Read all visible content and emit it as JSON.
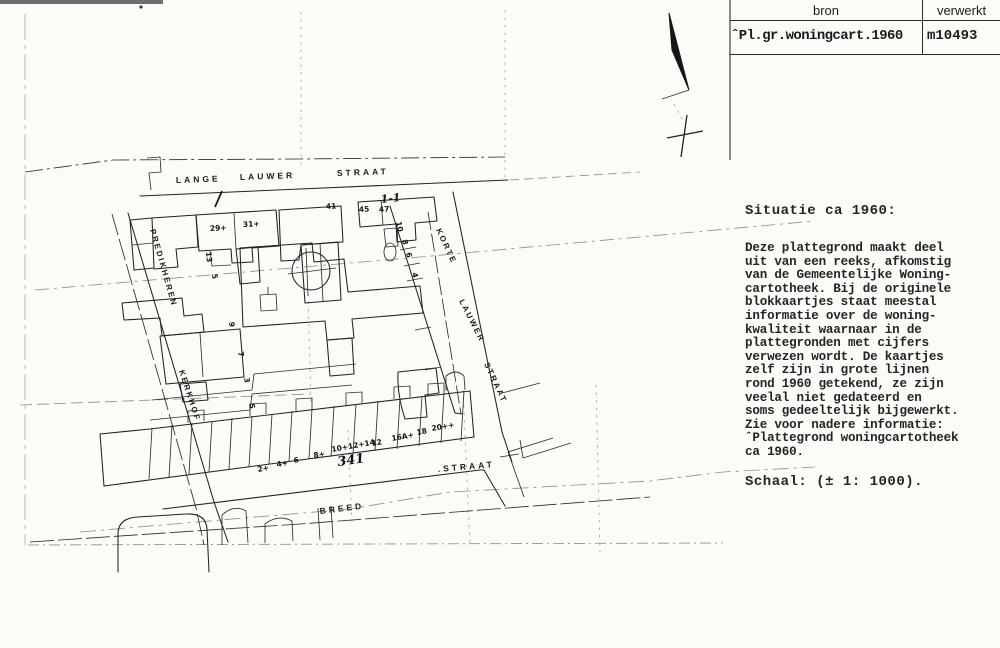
{
  "colors": {
    "ink": "#222222",
    "faint_line": "#8f8f8f",
    "paper": "#fbfbf8",
    "table_line": "#2b2b2b"
  },
  "table": {
    "col1_header": "bron",
    "col2_header": "verwerkt",
    "col1_value": "ˆPl.gr.woningcart.1960",
    "col2_value": "m10493"
  },
  "info": {
    "title": "Situatie ca 1960:",
    "body": "Deze plattegrond maakt deel\nuit van een reeks, afkomstig\nvan de Gemeentelijke Woning-\ncartotheek. Bij de originele\nblokkaartjes staat meestal\ninformatie over de woning-\nkwaliteit waarnaar in de\nplattegronden met cijfers\nverwezen wordt. De kaartjes\nzelf zijn in grote lijnen\nrond 1960 getekend, ze zijn\nveelal niet gedateerd en\nsoms gedeeltelijk bijgewerkt.\nZie voor nadere informatie:\nˆPlattegrond woningcartotheek\nca 1960.",
    "scale": "Schaal: (± 1: 1000)."
  },
  "map": {
    "streets": {
      "lange_lauwer": [
        "LANGE",
        "LAUWER",
        "STRAAT"
      ],
      "predikheren": [
        "PREDIKHEREN",
        "KERKHOF"
      ],
      "korte_lauwer": [
        "KORTE",
        "LAUWER",
        "STRAAT"
      ],
      "breed": [
        "BREED",
        ".STRAAT"
      ]
    },
    "house_numbers": {
      "top": [
        "29+",
        "31+",
        "41",
        "45",
        "47"
      ],
      "left": [
        "13",
        "5",
        "9",
        "7",
        "3",
        "5"
      ],
      "right": [
        "10",
        "8",
        "6",
        "4"
      ],
      "bottom": [
        "2+",
        "4+",
        "6",
        "8+",
        "10+12+14",
        "12",
        "16A+",
        "18",
        "20++"
      ]
    },
    "annotations": [
      "1-1",
      "341"
    ]
  }
}
